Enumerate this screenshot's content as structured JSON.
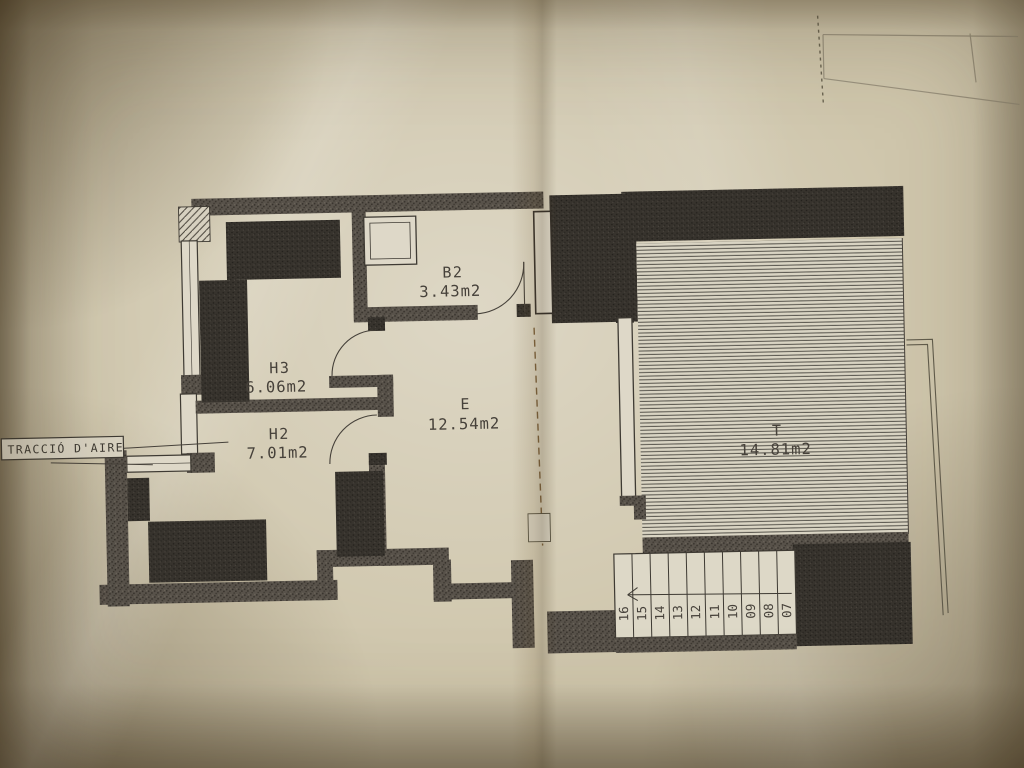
{
  "document_type": "architectural floor plan (photographed blueprint)",
  "plan": {
    "air_label": "TRACCIÓ D'AIRE",
    "rooms": [
      {
        "name": "H3",
        "area": "6.06m2"
      },
      {
        "name": "H2",
        "area": "7.01m2"
      },
      {
        "name": "B2",
        "area": "3.43m2"
      },
      {
        "name": "E",
        "area": "12.54m2"
      },
      {
        "name": "T",
        "area": "14.81m2"
      }
    ],
    "stairs": {
      "steps": [
        "16",
        "15",
        "14",
        "13",
        "12",
        "11",
        "10",
        "09",
        "08",
        "07"
      ]
    }
  },
  "colors": {
    "paper": "#cfc6ac",
    "ink": "#46413a",
    "wall_stipple": "#58524a",
    "dark_fill": "#37332d",
    "terrace_hatch_line": "#55524a",
    "fold_dash": "#7a5f3a",
    "pencil_faint": "#9a927e"
  }
}
